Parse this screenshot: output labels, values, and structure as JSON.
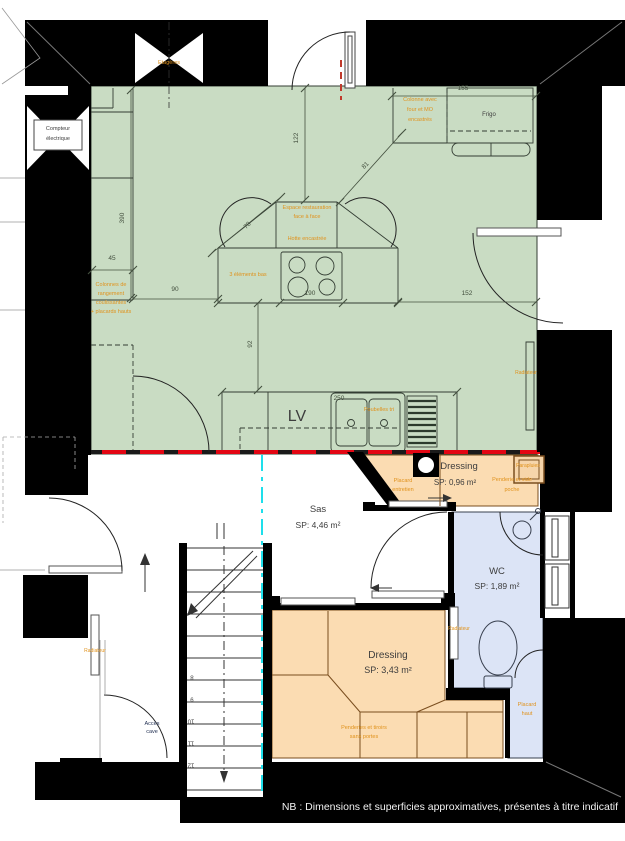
{
  "labels": {
    "etageres": "Etagères",
    "compteur_l1": "Compteur",
    "compteur_l2": "électrique",
    "colonne_l1": "Colonne avec",
    "colonne_l2": "four et MO",
    "colonne_l3": "encastrés",
    "frigo": "Frigo",
    "espace_l1": "Espace restauration",
    "espace_l2": "face à face",
    "hotte": "Hotte encastrée",
    "elements_bas": "3 éléments bas",
    "rangement_l1": "Colonnes de",
    "rangement_l2": "rangement",
    "rangement_l3": "coulissantes",
    "rangement_l4": "+ placards hauts",
    "poubelles": "Poubelles tri",
    "lave_vaisselle": "LV",
    "radiateur": "Radiateur",
    "placard_entretien_l1": "Placard",
    "placard_entretien_l2": "entretien",
    "penderie_l1": "Penderie et vide",
    "penderie_l2": "poche",
    "parapluies": "Parapluies",
    "placard_haut_l1": "Placard",
    "placard_haut_l2": "haut",
    "penderies_tiroirs_l1": "Penderies et tiroirs",
    "penderies_tiroirs_l2": "sans portes",
    "acces_cave_l1": "Accès",
    "acces_cave_l2": "cave"
  },
  "rooms": {
    "dressing_entry": {
      "name": "Dressing",
      "area": "SP: 0,96 m²"
    },
    "sas": {
      "name": "Sas",
      "area": "SP: 4,46 m²"
    },
    "wc": {
      "name": "WC",
      "area": "SP: 1,89 m²"
    },
    "dressing_main": {
      "name": "Dressing",
      "area": "SP: 3,43 m²"
    }
  },
  "dimensions": {
    "d45": "45",
    "d90": "90",
    "d92": "92",
    "d122": "122",
    "d152": "152",
    "d155": "155",
    "d190": "190",
    "d250": "250",
    "d390": "390",
    "d78": "78",
    "d81": "81"
  },
  "stair_steps": [
    "8",
    "9",
    "10",
    "11",
    "12"
  ],
  "colors": {
    "kitchen_fill": "#c9dcc3",
    "dressing_fill": "#fbdcb2",
    "wc_fill": "#dce4f6",
    "orange_text": "#e0921c",
    "red_line": "#e30613",
    "cyan_line": "#1edfeb"
  },
  "note": "NB : Dimensions et superficies approximatives, présentes à titre indicatif"
}
